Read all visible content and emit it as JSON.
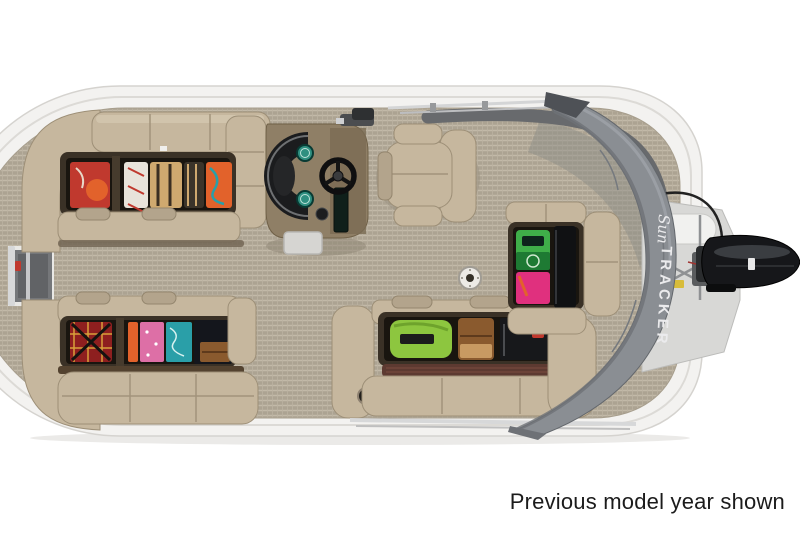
{
  "caption": {
    "text": "Previous model year shown"
  },
  "boat": {
    "cover_brand": {
      "script": "Sun",
      "block": "TRACKER"
    }
  },
  "colors": {
    "background": "#ffffff",
    "caption_text": "#1b1b1b",
    "hull_white": "#f3f2f0",
    "deck_floor_tan": "#b1a897",
    "upholstery_beige": "#c6b79e",
    "cover_gray": "#8a8e93",
    "fence_gray": "#686a6d",
    "motor_black": "#16171a",
    "stern_platform_gray": "#d8d8d6",
    "gauge_teal": "#2f8f80",
    "rail_silver": "#d7d8d9",
    "brand_text": "#ebebed",
    "gear_colors": [
      "#c0392e",
      "#e2622b",
      "#dd6fa6",
      "#2a9fa8",
      "#8dc63f",
      "#3fae49",
      "#e0307e",
      "#cfa96f",
      "#8a5a2e",
      "#5d3a31"
    ]
  }
}
